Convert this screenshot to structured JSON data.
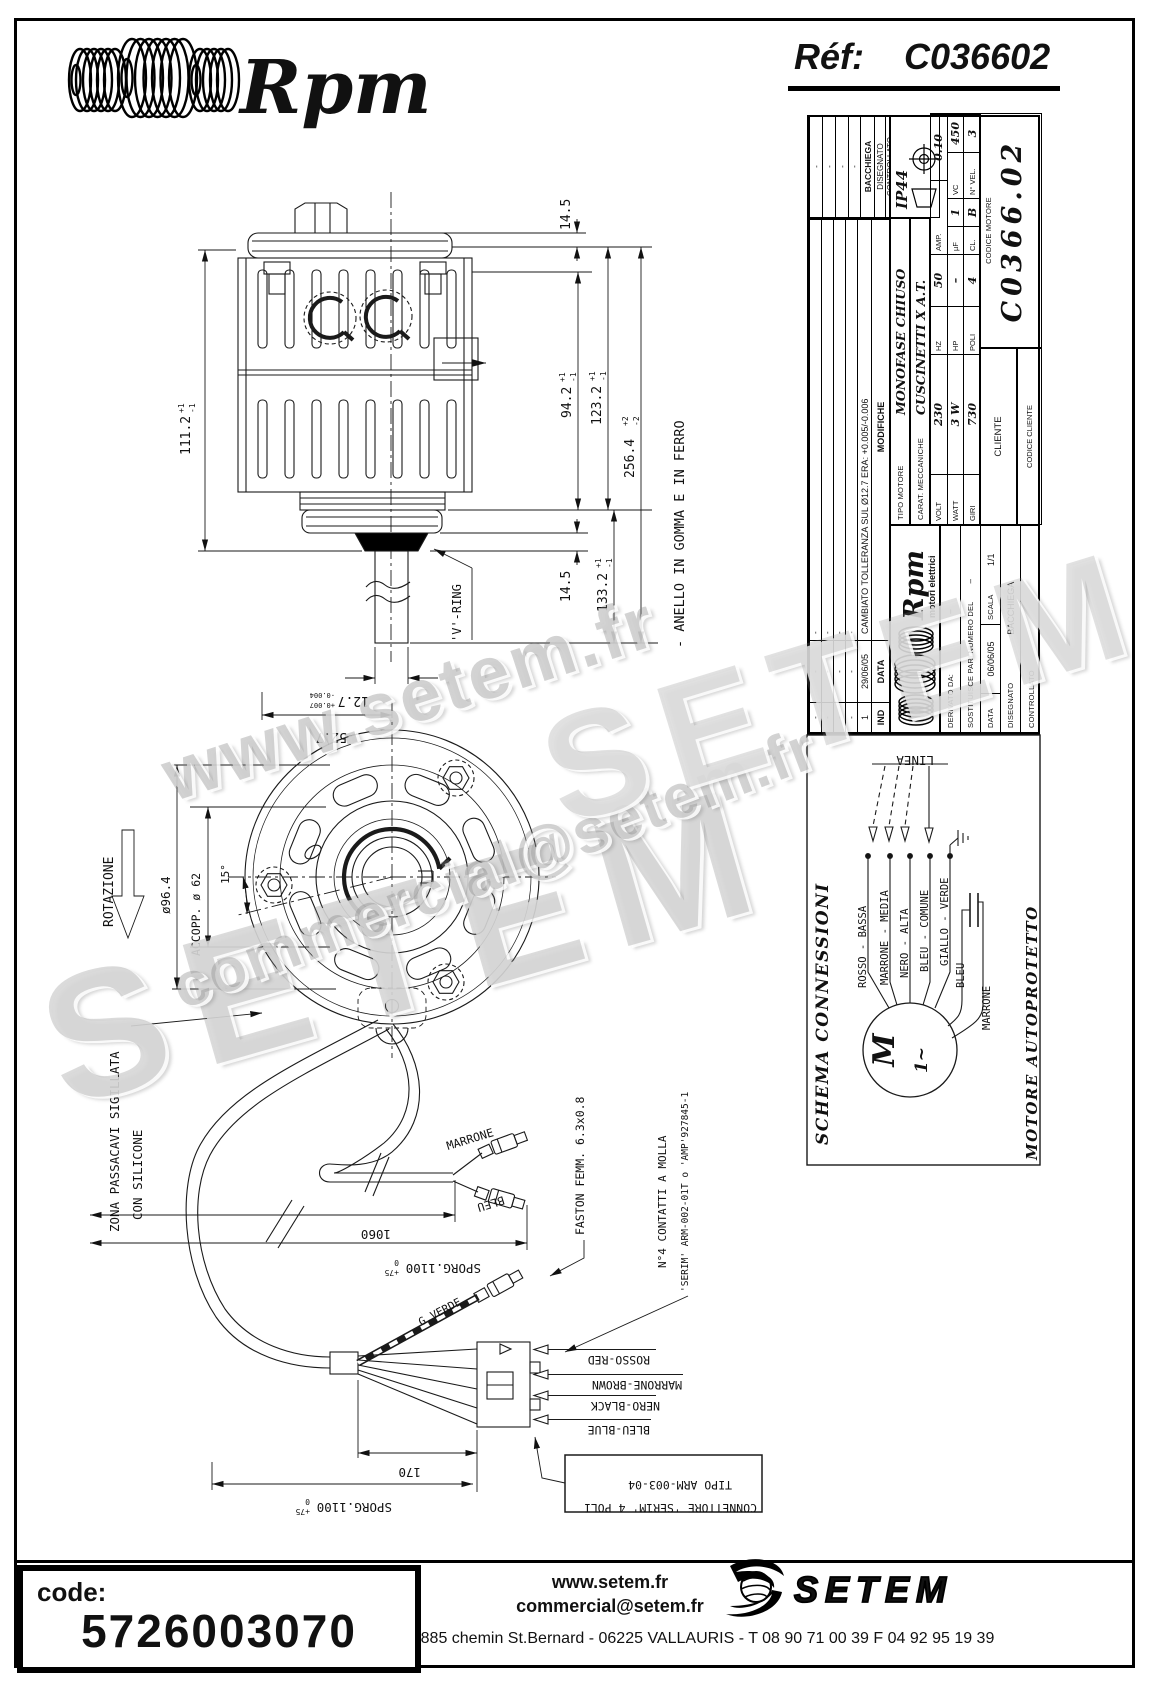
{
  "header": {
    "brand": "Rpm",
    "ref_label": "Réf:",
    "ref_value": "C036602"
  },
  "title_block": {
    "revisions": {
      "rows": [
        [
          "-",
          "-",
          "-"
        ],
        [
          "-",
          "-",
          "-"
        ],
        [
          "-",
          "-",
          "-"
        ],
        [
          "-",
          "-",
          "-"
        ],
        [
          "1",
          "29/06/05",
          "CAMBIATO TOLLERANZA SUL Ø12.7 ERA: +0.005/-0.006"
        ]
      ],
      "headers": [
        "IND",
        "DATA",
        "MODIFICHE"
      ]
    },
    "right_marks": [
      "-",
      "-",
      "-",
      "-"
    ],
    "disegnato_label": "DISEGNATO",
    "disegnato_value": "BACCHIEGA",
    "controllato_label": "CONTROLLATO",
    "protection": "IP44",
    "tipo_label": "TIPO MOTORE",
    "tipo_value": "MONOFASE CHIUSO",
    "carat_label": "CARAT. MECCANICHE",
    "carat_value": "CUSCINETTI X A.T.",
    "logo_text": "Rpm",
    "logo_sub": "motori elettrici",
    "specs": {
      "volt_l": "VOLT",
      "volt_v": "230",
      "hz_l": "HZ",
      "hz_v": "50",
      "amp_l": "AMP.",
      "amp_v": "0.10",
      "watt_l": "WATT",
      "watt_v": "3 W",
      "hp_l": "HP",
      "hp_v": "–",
      "uf_l": "µF",
      "uf_v": "1",
      "vc_l": "VC",
      "vc_v": "450",
      "giri_l": "GIRI",
      "giri_v": "730",
      "poli_l": "POLI",
      "poli_v": "4",
      "cl_l": "CL.",
      "cl_v": "B",
      "nvel_l": "N° VEL.",
      "nvel_v": "3"
    },
    "derivato_label": "DERIVATO DA:",
    "derivato_value": "–",
    "sostituisce_label": "SOSTITUISCE PARI NUMERO DEL",
    "sostituisce_value": "–",
    "data_label": "DATA",
    "data_value": "06/06/05",
    "scala_label": "SCALA",
    "scala_value": "1/1",
    "disegnato2_label": "DISEGNATO",
    "disegnato2_value": "BACCHIEGA",
    "controllato2_label": "CONTROLLATO",
    "cliente_label": "CLIENTE",
    "codice_cliente_label": "CODICE CLIENTE",
    "codice_motore_label": "CODICE MOTORE",
    "codice_motore_value": "C0366.02"
  },
  "drawing": {
    "dims": {
      "d111": "111.2",
      "d111_sup": "+1",
      "d111_sub": "-1",
      "d14_5_top": "14.5",
      "d94": "94.2",
      "d94_sup": "+1",
      "d94_sub": "-1",
      "d123": "123.2",
      "d123_sup": "+1",
      "d123_sub": "-1",
      "d256": "256.4",
      "d256_sup": "+2",
      "d256_sub": "-2",
      "d14_5_bot": "14.5",
      "d133": "133.2",
      "d133_sup": "+1",
      "d133_sub": "-1",
      "d12_7": "12.7",
      "d12_7_sup": "+0.007",
      "d12_7_sub": "-0.004",
      "d52_7": "52.7",
      "d96": "ø96.4",
      "accopp": "ACCOPP. ø 62",
      "a15": "15°",
      "d1060": "1060",
      "sporg": "SPORG.1100",
      "sporg_sup": "+75",
      "sporg_sub": "0",
      "d170": "170"
    },
    "labels": {
      "vring": "'V'-RING",
      "anello": "- ANELLO IN GOMMA E IN FERRO",
      "rotazione": "ROTAZIONE",
      "zona1": "ZONA PASSACAVI SIGILLATA",
      "zona2": "CON SILICONE",
      "marrone": "MARRONE",
      "bleu": "BLEU",
      "gverde": "G.VERDE",
      "faston": "FASTON FEMM. 6.3x0.8",
      "contatti1": "N°4 CONTATTI A MOLLA",
      "contatti2": "'SERIM' ARM-002-01T o 'AMP'927845-1",
      "rosso_red": "ROSSO-RED",
      "marrone_brown": "MARRONE-BROWN",
      "nero_black": "NERO-BLACK",
      "bleu_blue": "BLEU-BLUE",
      "conn1": "TIPO ARM-003-04",
      "conn2": "CONNETTORE 'SER1M' 4 POLI"
    }
  },
  "schema": {
    "title": "SCHEMA CONNESSIONI",
    "linea": "LINEA",
    "wires": [
      "ROSSO - BASSA",
      "MARRONE - MEDIA",
      "NERO - ALTA",
      "BLEU - COMUNE",
      "GIALLO - VERDE"
    ],
    "cap_wires": [
      "BLEU",
      "MARRONE"
    ],
    "motor_m": "M",
    "motor_phase": "1~",
    "bottom": "MOTORE AUTOPROTETTO"
  },
  "watermarks": [
    "www.setem.fr",
    "SETEM",
    "commercial@setem.fr",
    "SETEM"
  ],
  "footer": {
    "code_label": "code:",
    "code_value": "5726003070",
    "site": "www.setem.fr",
    "email": "commercial@setem.fr",
    "brand": "SETEM",
    "address": "885 chemin St.Bernard  -  06225 VALLAURIS  -  T 08 90 71 00 39   F 04 92 95 19 39"
  }
}
